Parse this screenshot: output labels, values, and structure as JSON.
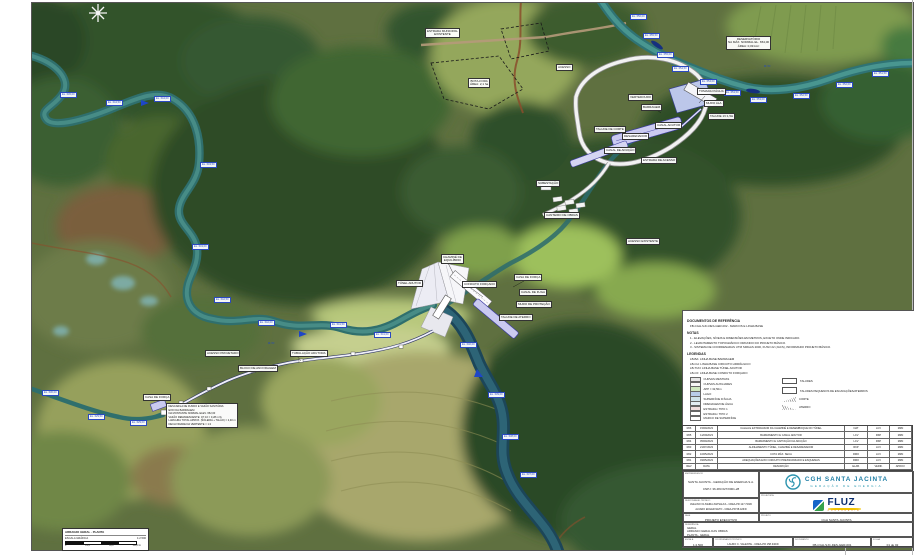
{
  "colors": {
    "logo_teal": "#1f7fa6",
    "logo_teal2": "#2a9ab0",
    "fluz_blue": "#1565c8",
    "fluz_navy": "#0c2f70",
    "fluz_yellow": "#f2c400",
    "marker_blue": "#2a49c0",
    "channel_purple": "#cacaf0",
    "river_teal": "#2f6f6d"
  },
  "map": {
    "white_labels": [
      {
        "x": 425,
        "y": 28,
        "lines": [
          "ESTRADA MUNICIPAL",
          "EXISTENTE"
        ]
      },
      {
        "x": 556,
        "y": 64,
        "lines": [
          "ACESSO"
        ]
      },
      {
        "x": 468,
        "y": 78,
        "lines": [
          "BOTA-FORA",
          "ÁREA: 2,1 ha"
        ]
      },
      {
        "x": 726,
        "y": 36,
        "lines": [
          "RESERVATÓRIO",
          "NA MÁX. NORMAL EL. 654,00",
          "ÁREA: 0,09 km²"
        ]
      },
      {
        "x": 628,
        "y": 94,
        "lines": [
          "VERTEDOURO"
        ]
      },
      {
        "x": 641,
        "y": 104,
        "lines": [
          "BARRAGEM"
        ]
      },
      {
        "x": 697,
        "y": 88,
        "lines": [
          "TOMADA D'ÁGUA"
        ]
      },
      {
        "x": 704,
        "y": 100,
        "lines": [
          "MURO ALA"
        ]
      },
      {
        "x": 708,
        "y": 113,
        "lines": [
          "TALUDE 1V:1,5H"
        ]
      },
      {
        "x": 655,
        "y": 122,
        "lines": [
          "CANAL ADUTOR"
        ]
      },
      {
        "x": 622,
        "y": 133,
        "lines": [
          "DESARENADOR"
        ]
      },
      {
        "x": 594,
        "y": 126,
        "lines": [
          "TALUDE DE CORTE"
        ]
      },
      {
        "x": 604,
        "y": 147,
        "lines": [
          "CANAL DE ADUÇÃO"
        ]
      },
      {
        "x": 641,
        "y": 157,
        "lines": [
          "ESTRADA DE ACESSO"
        ]
      },
      {
        "x": 536,
        "y": 180,
        "lines": [
          "SUBESTAÇÃO"
        ]
      },
      {
        "x": 544,
        "y": 212,
        "lines": [
          "CANTEIRO DE OBRAS"
        ]
      },
      {
        "x": 626,
        "y": 238,
        "lines": [
          "ACESSO EXISTENTE"
        ]
      },
      {
        "x": 441,
        "y": 254,
        "lines": [
          "CHAMINÉ DE",
          "EQUILÍBRIO"
        ]
      },
      {
        "x": 396,
        "y": 280,
        "lines": [
          "TÚNEL ADUTOR"
        ]
      },
      {
        "x": 462,
        "y": 281,
        "lines": [
          "CONDUTO FORÇADO"
        ]
      },
      {
        "x": 514,
        "y": 274,
        "lines": [
          "CASA DE FORÇA"
        ]
      },
      {
        "x": 519,
        "y": 289,
        "lines": [
          "CANAL DE FUGA"
        ]
      },
      {
        "x": 516,
        "y": 301,
        "lines": [
          "MURO DE PROTEÇÃO"
        ]
      },
      {
        "x": 499,
        "y": 314,
        "lines": [
          "TALUDE DE ATERRO"
        ]
      },
      {
        "x": 290,
        "y": 350,
        "lines": [
          "TUBULAÇÃO ADUTORA"
        ]
      },
      {
        "x": 238,
        "y": 365,
        "lines": [
          "BLOCO DE ANCORAGEM"
        ]
      },
      {
        "x": 205,
        "y": 350,
        "lines": [
          "ACESSO PROJETADO"
        ]
      },
      {
        "x": 143,
        "y": 394,
        "lines": [
          "CASA DE FORÇA"
        ]
      }
    ],
    "blue_markers": [
      {
        "x": 630,
        "y": 14,
        "t": "EL. 656,00"
      },
      {
        "x": 643,
        "y": 33,
        "t": "EL. 655,50"
      },
      {
        "x": 657,
        "y": 52,
        "t": "EL. 655,00"
      },
      {
        "x": 672,
        "y": 66,
        "t": "EL. 654,50"
      },
      {
        "x": 700,
        "y": 79,
        "t": "EL. 654,00"
      },
      {
        "x": 724,
        "y": 90,
        "t": "EL. 653,50"
      },
      {
        "x": 750,
        "y": 97,
        "t": "EL. 653,00"
      },
      {
        "x": 793,
        "y": 93,
        "t": "EL. 652,50"
      },
      {
        "x": 836,
        "y": 82,
        "t": "EL. 652,00"
      },
      {
        "x": 872,
        "y": 71,
        "t": "EL. 651,50"
      },
      {
        "x": 60,
        "y": 92,
        "t": "EL. 645,00"
      },
      {
        "x": 106,
        "y": 100,
        "t": "EL. 644,50"
      },
      {
        "x": 154,
        "y": 96,
        "t": "EL. 644,00"
      },
      {
        "x": 200,
        "y": 162,
        "t": "EL. 643,50"
      },
      {
        "x": 192,
        "y": 244,
        "t": "EL. 643,00"
      },
      {
        "x": 214,
        "y": 297,
        "t": "EL. 642,50"
      },
      {
        "x": 258,
        "y": 320,
        "t": "EL. 642,00"
      },
      {
        "x": 330,
        "y": 322,
        "t": "EL. 641,50"
      },
      {
        "x": 374,
        "y": 332,
        "t": "EL. 641,00"
      },
      {
        "x": 460,
        "y": 342,
        "t": "EL. 640,00"
      },
      {
        "x": 488,
        "y": 392,
        "t": "EL. 639,00"
      },
      {
        "x": 502,
        "y": 434,
        "t": "EL. 638,00"
      },
      {
        "x": 520,
        "y": 472,
        "t": "EL. 637,00"
      },
      {
        "x": 42,
        "y": 390,
        "t": "EL. 630,00"
      },
      {
        "x": 88,
        "y": 414,
        "t": "EL. 629,50"
      },
      {
        "x": 130,
        "y": 420,
        "t": "EL. 629,00"
      }
    ],
    "river_names": [
      {
        "x": 268,
        "y": 341,
        "t": "RIO"
      },
      {
        "x": 764,
        "y": 64,
        "t": "RIO"
      }
    ],
    "note_box": {
      "x": 166,
      "y": 403,
      "lines": [
        "DESCARGA DE FUNDO E VAZÃO SANITÁRIA:",
        "EIXO DA BARRAGEM",
        "NA MONTANTE NORMAL ELEV. 652,00",
        "VAZÃO REMANESCENTE: Q7,10 = 0,28 m³/s",
        "LARGURA TOTAL APROX. (SOLEIRA + TALÃO) = 2,40 m",
        "DECLIVIDADE DA VERTENTE = 1:2"
      ]
    }
  },
  "panel": {
    "ref_title": "DOCUMENTOS DE REFERÊNCIA",
    "ref_items": [
      "FB-CGH-SJC-DES-GER-002 - MARCOS E LINHA BASE"
    ],
    "notes_title": "NOTAS",
    "notes": [
      "1 - ELEVAÇÕES, NÍVEIS E DIMENSÕES EM METROS, EXCETO ONDE INDICADO.",
      "2 - LEVANTAMENTO TOPOGRÁFICO ORIUNDO DO PROJETO BÁSICO.",
      "3 - SISTEMA DE COORDENADAS UTM SIRGAS 2000, FUSO 22 (JACS), INFORMADO PROJETO BÁSICO."
    ],
    "legend_title": "LEGENDAS",
    "legend_lines": [
      "LB-BA: LINHA BASE BARRAGEM",
      "LB-CH: LINHA BASE CIRCUITO HIDRÁULICO",
      "LB-TUN: LINHA BASE TÚNEL ADUTOR",
      "LB-CF: LINHA BASE CONDUTO FORÇADO"
    ],
    "swatches": [
      {
        "c": "#e8e8e8",
        "label": "CURVAS MESTRAS"
      },
      {
        "c": "#f7f7f7",
        "label": "CURVAS AUXILIARES"
      },
      {
        "c": "#cfe8c0",
        "label": "APP = 32,50m"
      },
      {
        "c": "#b9cdea",
        "label": "LAGO"
      },
      {
        "c": "#cfe3ea",
        "label": "SUPERFÍCIE D'ÁGUA"
      },
      {
        "c": "#e3edf2",
        "label": "DRENAGEM DE ÁGUA"
      },
      {
        "c": "#f0dede",
        "label": "ESTRADA / TIPO 1"
      },
      {
        "c": "#ffffff",
        "label": "ESTRADA / TIPO 2"
      },
      {
        "c": "#ffffff",
        "label": "MARCO DE SUPERFÍCIE"
      }
    ],
    "legend_right": [
      {
        "kind": "box",
        "label": "TALUDES"
      },
      {
        "kind": "box",
        "label": "TALUDES PEQUENOS DE ESCAVAÇÕES/ATERROS"
      },
      {
        "kind": "corte",
        "label": "CORTE"
      },
      {
        "kind": "aterro",
        "label": "ATERRO"
      }
    ]
  },
  "revisions": {
    "rows": [
      [
        "R06",
        "15/09/2023",
        "CALHA E EXTRAVASOR DA CHAMINÉ E DESEMBOQUE DO TÚNEL",
        "NAT",
        "LCV",
        "MZN"
      ],
      [
        "R05",
        "11/09/2023",
        "BARRAMENTO E CANAL ADUTOR",
        "LCV",
        "RKP",
        "MZN"
      ],
      [
        "R04",
        "05/09/2023",
        "BARRAMENTO E CAPTAÇÃO DA ADUÇÃO",
        "LCV",
        "RKP",
        "MZN"
      ],
      [
        "R03",
        "21/07/2023",
        "ALINHAMENTO TÚNEL, CHAMINÉ E DESARENADOR",
        "RKP",
        "LCV",
        "MZN"
      ],
      [
        "R02",
        "10/05/2023",
        "COTA MÁX. SECA",
        "RMO",
        "LCV",
        "MZN"
      ],
      [
        "R01",
        "03/05/2023",
        "ADEQUAÇÕES EIXO CIRCUITO PRESSURIZADO E ESQUEMAS",
        "RMO",
        "LCV",
        "MZN"
      ],
      [
        "REV",
        "DATA",
        "DESCRIÇÃO",
        "ELAB.",
        "VERIF.",
        "APROV."
      ]
    ]
  },
  "titleblock": {
    "owner_header": "EMPREENDEDOR",
    "owner_lines": [
      "SANTA JACINTA - GERAÇÃO DE ENERGIA S.A.",
      "CNPJ: 36.483.627/0001-28"
    ],
    "resp_header": "RESPONSÁVEL TÉCNICO",
    "resp_lines": [
      "AVELINO OLIVEIRA ZAPSALKA - CREA-PR 127.729/D",
      "ALVARO ENGER NETO - CREA-PR 58.426/D"
    ],
    "fase_header": "FASE",
    "fase_value": "PROJETO EXECUTIVO",
    "projetista_header": "PROJETISTA",
    "projeto_header": "PROJETO",
    "projeto_value": "CGH SANTA JACINTA",
    "ref_header": "REFERÊNCIA",
    "ref_lines": [
      "GERAL",
      "ARRANJO GERAL DAS OBRAS",
      "PLANTA - GERAL"
    ],
    "escala_header": "ESCALA",
    "escala_value": "1:2.500",
    "coord_header": "COORDENADOR TÉCNICO",
    "coord_value": "LAURO C. VALENTE - CREA-PR 158.340/D",
    "doc_header": "DOCUMENTO",
    "doc_value": "FB-CGH-SJC-DES-GER-001",
    "folha_header": "FOLHA",
    "folha_value": "01 de 02",
    "logo_name": "CGH SANTA JACINTA",
    "logo_tagline": "GERAÇÃO DE ENERGIA",
    "fluz_name": "FLUZ",
    "fluz_sub": "ENGENHARIA"
  },
  "scalebox": {
    "title": "ARRANJO GERAL - PLANTA",
    "label": "ESCALA GRÁFICA",
    "scale": "1:2.500",
    "nums": [
      "0",
      "25,0",
      "50,0",
      "100,0 m"
    ]
  }
}
